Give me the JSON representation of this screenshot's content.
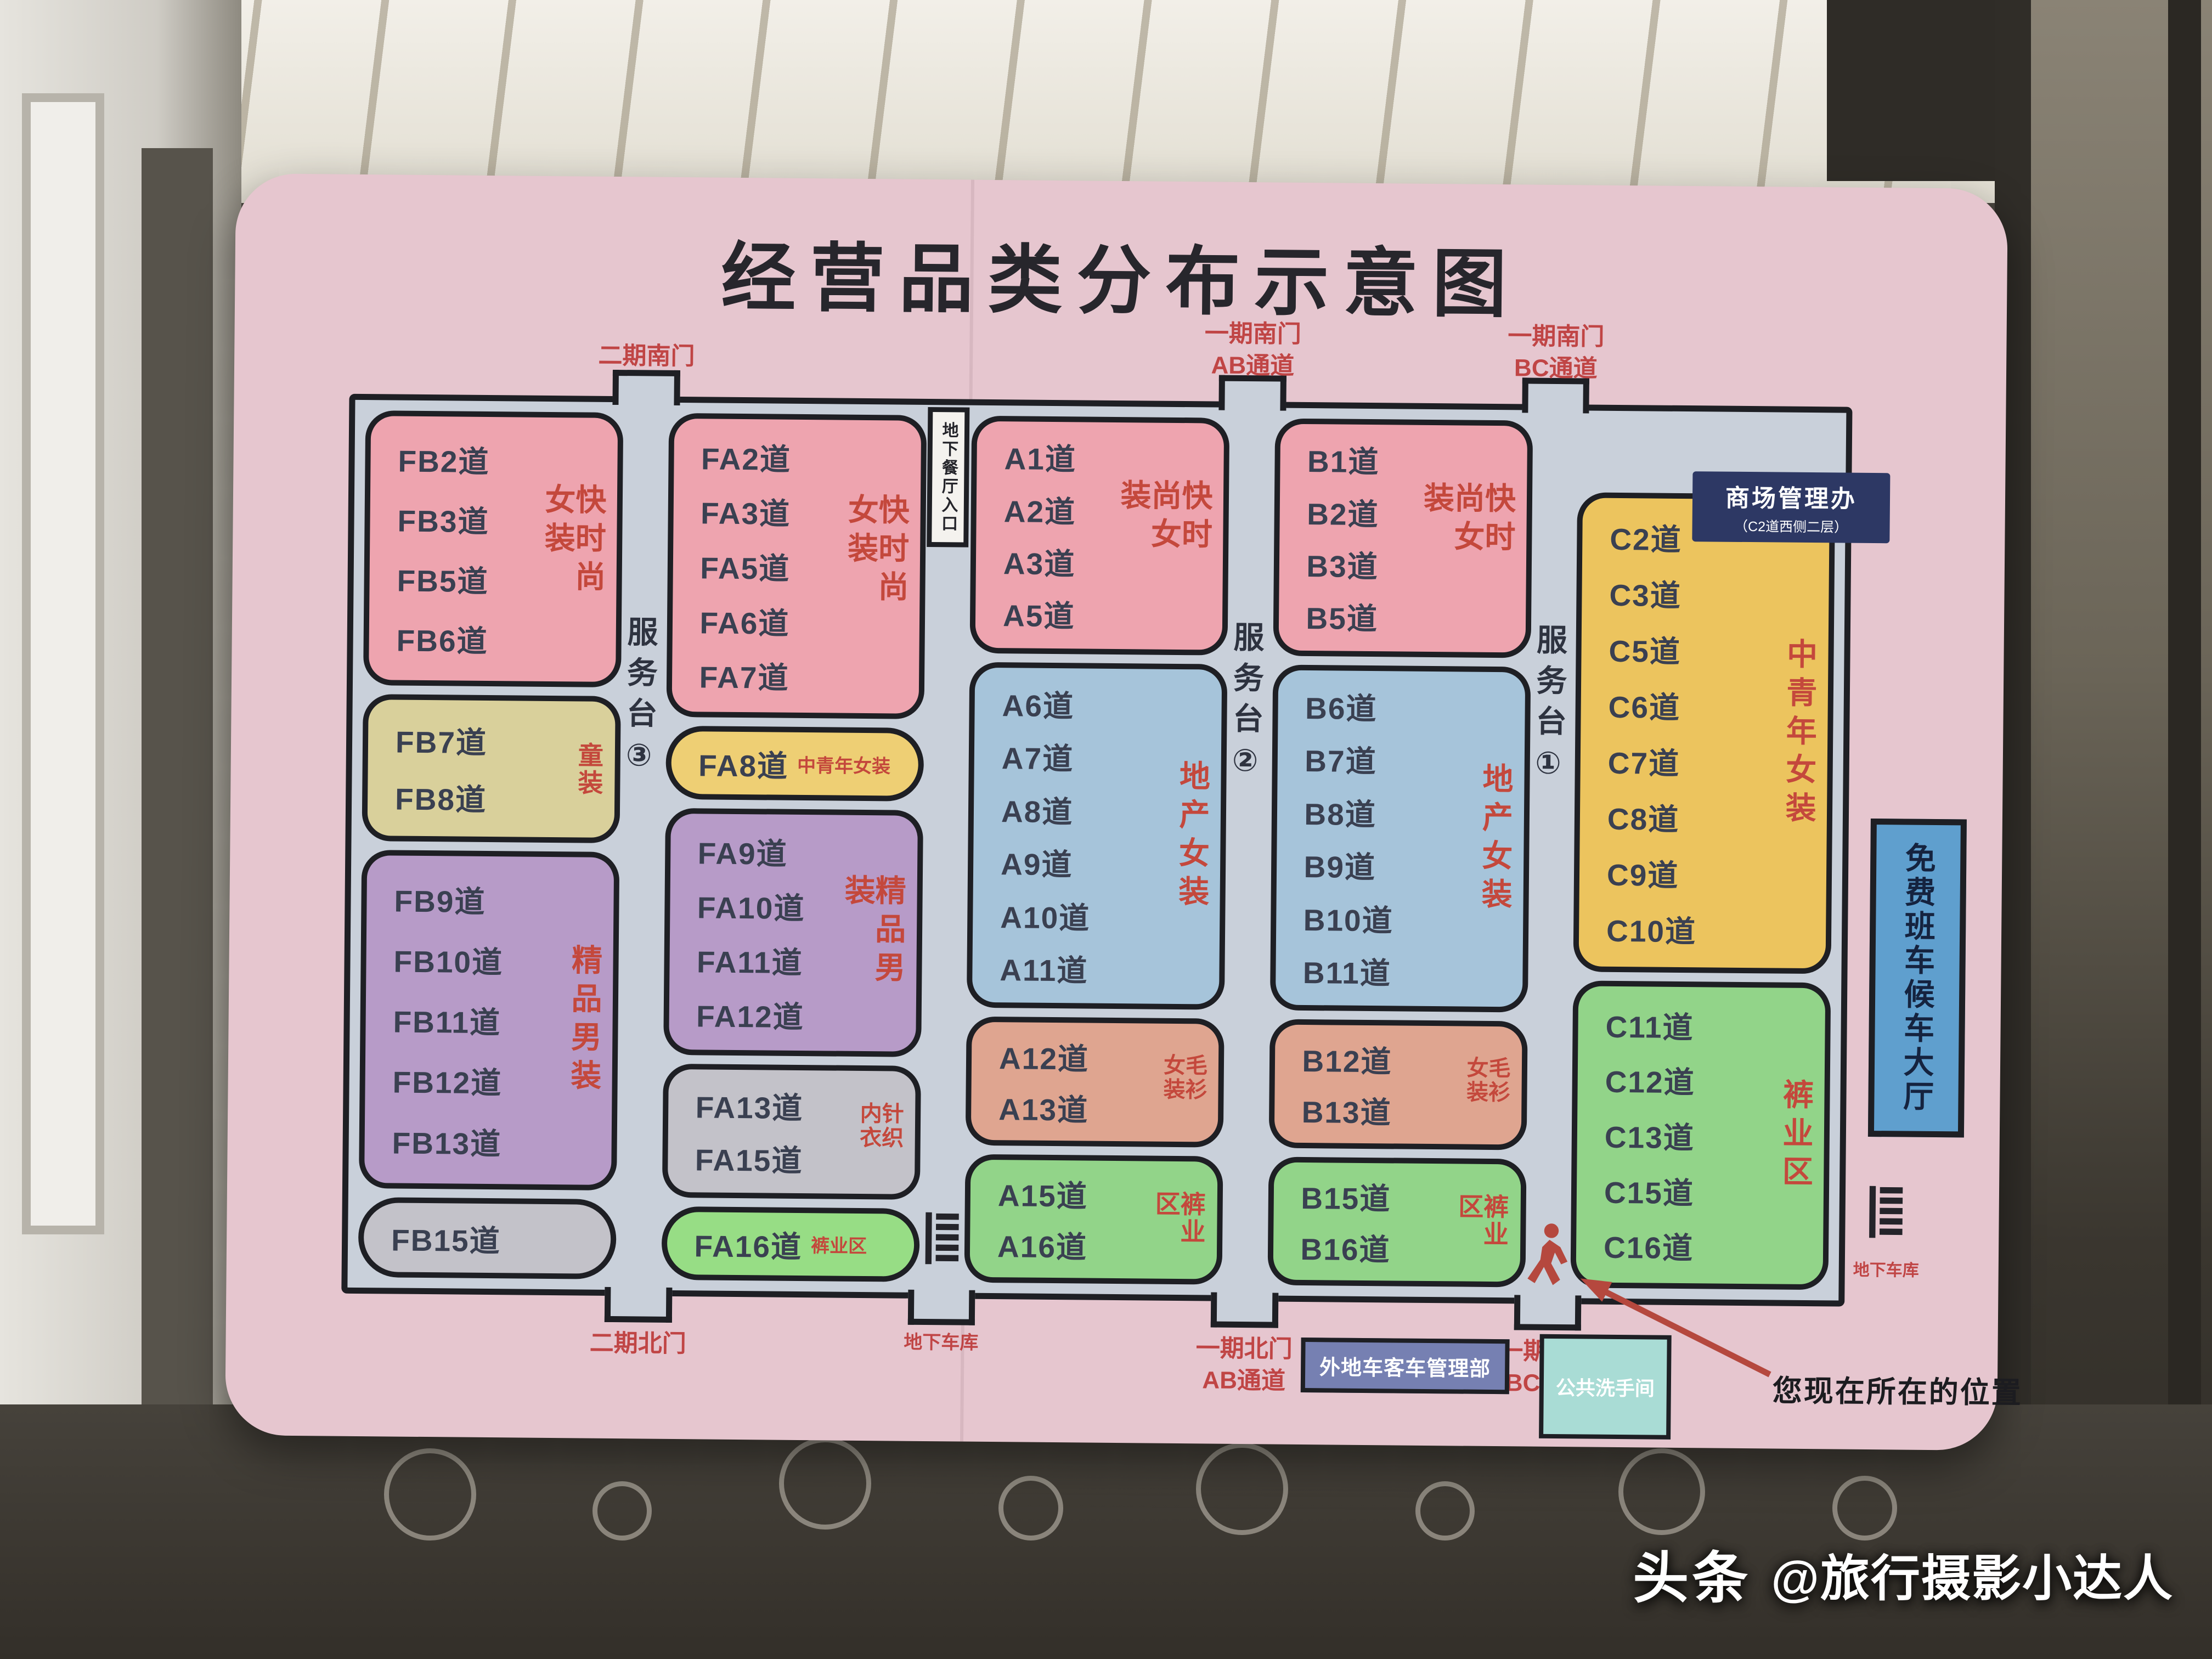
{
  "title": "经营品类分布示意图",
  "watermark": {
    "brand": "头条",
    "handle": "@旅行摄影小达人"
  },
  "palette": {
    "poster_bg": "#e6c6cf",
    "corridor": "#c9d0da",
    "outline": "#1e1f24",
    "lane_text": "#3a4051",
    "category_text": "#c4483c",
    "door_text": "#c04545",
    "pink": "#eea4af",
    "khaki": "#d9d09b",
    "purple": "#b79bc8",
    "gray": "#c3c2c9",
    "blue": "#a6c4da",
    "salmon": "#dfa590",
    "green": "#92d489",
    "green_bright": "#97dd85",
    "yellow": "#eecf74",
    "yellow_deep": "#ecc45e",
    "shuttle_bg": "#5f9fce",
    "office_bg": "#2d3864",
    "bus_office_bg": "#7680b2",
    "restroom_bg": "#a9dcd5",
    "person": "#b5483e"
  },
  "labels": {
    "shuttle_hall": "免费班车候车大厅",
    "bus_office": "外地车客车管理部",
    "restroom": "公共洗手间",
    "you_are_here": "您现在所在的位置",
    "garage_right": "地下车库",
    "management_office_line1": "商场管理办",
    "management_office_line2": "（C2道西侧二层）"
  },
  "map": {
    "columns": [
      {
        "id": "FB",
        "blocks": [
          {
            "color": "pink",
            "category": "快时尚女装",
            "lanes": [
              "FB2道",
              "FB3道",
              "FB5道",
              "FB6道"
            ]
          },
          {
            "color": "khaki",
            "category": "童装",
            "lanes": [
              "FB7道",
              "FB8道"
            ]
          },
          {
            "color": "purple",
            "category": "精品男装",
            "lanes": [
              "FB9道",
              "FB10道",
              "FB11道",
              "FB12道",
              "FB13道"
            ]
          },
          {
            "color": "gray",
            "category": "",
            "lanes": [
              "FB15道"
            ],
            "pill": true
          }
        ]
      },
      {
        "id": "FA",
        "blocks": [
          {
            "color": "pink",
            "category": "快时尚女装",
            "lanes": [
              "FA2道",
              "FA3道",
              "FA5道",
              "FA6道",
              "FA7道"
            ]
          },
          {
            "color": "yellow",
            "category": "中青年女装",
            "lanes": [
              "FA8道"
            ],
            "pill": true,
            "inline": true
          },
          {
            "color": "purple",
            "category": "精品男装",
            "lanes": [
              "FA9道",
              "FA10道",
              "FA11道",
              "FA12道"
            ]
          },
          {
            "color": "gray",
            "category": "针织内衣",
            "lanes": [
              "FA13道",
              "FA15道"
            ]
          },
          {
            "color": "green_bright",
            "category": "裤业区",
            "lanes": [
              "FA16道"
            ],
            "pill": true,
            "inline": true
          }
        ]
      },
      {
        "id": "A",
        "blocks": [
          {
            "color": "pink",
            "category": "快时尚女装",
            "lanes": [
              "A1道",
              "A2道",
              "A3道",
              "A5道"
            ]
          },
          {
            "color": "blue",
            "category": "地产女装",
            "lanes": [
              "A6道",
              "A7道",
              "A8道",
              "A9道",
              "A10道",
              "A11道"
            ]
          },
          {
            "color": "salmon",
            "category": "毛衫女装",
            "lanes": [
              "A12道",
              "A13道"
            ]
          },
          {
            "color": "green",
            "category": "裤业区",
            "lanes": [
              "A15道",
              "A16道"
            ]
          }
        ]
      },
      {
        "id": "B",
        "blocks": [
          {
            "color": "pink",
            "category": "快时尚女装",
            "lanes": [
              "B1道",
              "B2道",
              "B3道",
              "B5道"
            ]
          },
          {
            "color": "blue",
            "category": "地产女装",
            "lanes": [
              "B6道",
              "B7道",
              "B8道",
              "B9道",
              "B10道",
              "B11道"
            ]
          },
          {
            "color": "salmon",
            "category": "毛衫女装",
            "lanes": [
              "B12道",
              "B13道"
            ]
          },
          {
            "color": "green",
            "category": "裤业区",
            "lanes": [
              "B15道",
              "B16道"
            ]
          }
        ]
      },
      {
        "id": "C",
        "blocks": [
          {
            "color": "yellow_deep",
            "category": "中青年女装",
            "lanes": [
              "C2道",
              "C3道",
              "C5道",
              "C6道",
              "C7道",
              "C8道",
              "C9道",
              "C10道"
            ]
          },
          {
            "color": "green",
            "category": "裤业区",
            "lanes": [
              "C11道",
              "C12道",
              "C13道",
              "C15道",
              "C16道"
            ]
          }
        ]
      }
    ],
    "corridor_labels": [
      {
        "gap": 0,
        "label": "服务台③"
      },
      {
        "gap": 2,
        "label": "服务台②"
      },
      {
        "gap": 3,
        "label": "服务台①"
      }
    ],
    "restaurant_entrance": {
      "gap": 1,
      "label": "地下餐厅入口"
    },
    "doors": {
      "top": [
        {
          "gap": 0,
          "lines": [
            "二期南门"
          ]
        },
        {
          "gap": 2,
          "lines": [
            "一期南门",
            "AB通道"
          ]
        },
        {
          "gap": 3,
          "lines": [
            "一期南门",
            "BC通道"
          ]
        }
      ],
      "bottom": [
        {
          "gap": 0,
          "lines": [
            "二期北门"
          ]
        },
        {
          "gap": 1,
          "lines": [
            "地下车库"
          ],
          "escalator": true,
          "small": true
        },
        {
          "gap": 2,
          "lines": [
            "一期北门",
            "AB通道"
          ]
        },
        {
          "gap": 3,
          "lines": [
            "一期北门",
            "BC通道"
          ]
        }
      ]
    }
  }
}
